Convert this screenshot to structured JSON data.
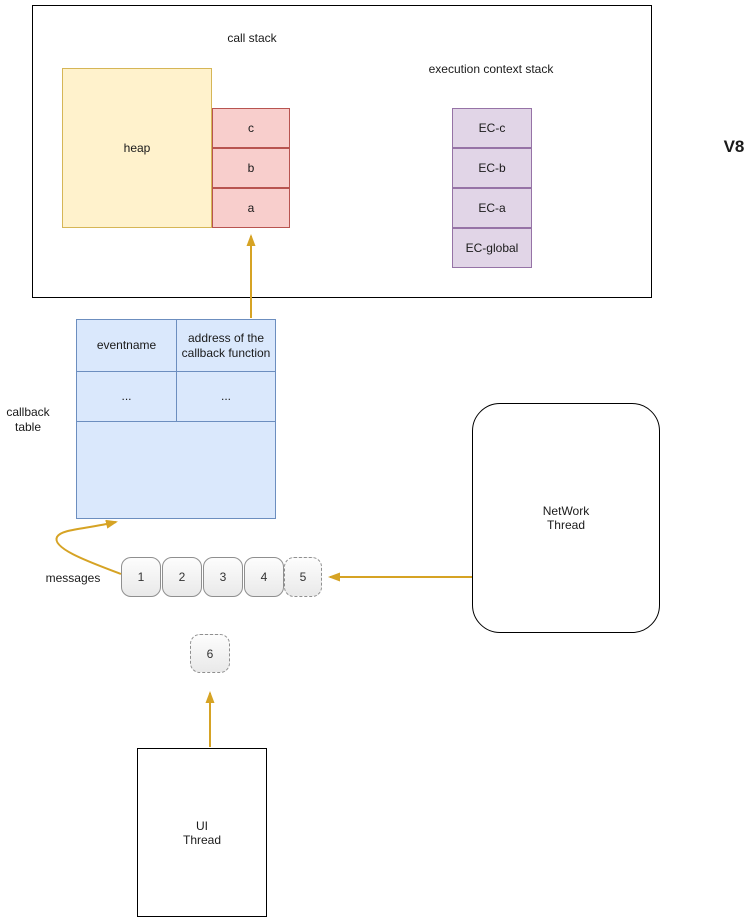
{
  "diagram": {
    "v8": {
      "label": "V8",
      "call_stack": {
        "title": "call stack",
        "heap_label": "heap",
        "frames": [
          "c",
          "b",
          "a"
        ]
      },
      "execution_context_stack": {
        "title": "execution context stack",
        "items": [
          "EC-c",
          "EC-b",
          "EC-a",
          "EC-global"
        ]
      }
    },
    "callback_table": {
      "label": "callback\ntable",
      "headers": [
        "eventname",
        "address of the callback function"
      ],
      "rows": [
        [
          "...",
          "..."
        ]
      ]
    },
    "message_queue": {
      "label": "messages",
      "items": [
        "1",
        "2",
        "3",
        "4",
        "5"
      ],
      "incoming_item": "6"
    },
    "network_thread": {
      "label": "NetWork\nThread"
    },
    "ui_thread": {
      "label": "UI\nThread"
    },
    "colors": {
      "heap_fill": "#FFF2CC",
      "heap_stroke": "#D6B656",
      "stack_frame_fill": "#F8CECC",
      "stack_frame_stroke": "#B85450",
      "execution_context_fill": "#E1D5E7",
      "execution_context_stroke": "#9673A6",
      "callback_table_fill": "#DAE8FC",
      "callback_table_stroke": "#6C8EBF",
      "arrow": "#D6A324"
    }
  }
}
